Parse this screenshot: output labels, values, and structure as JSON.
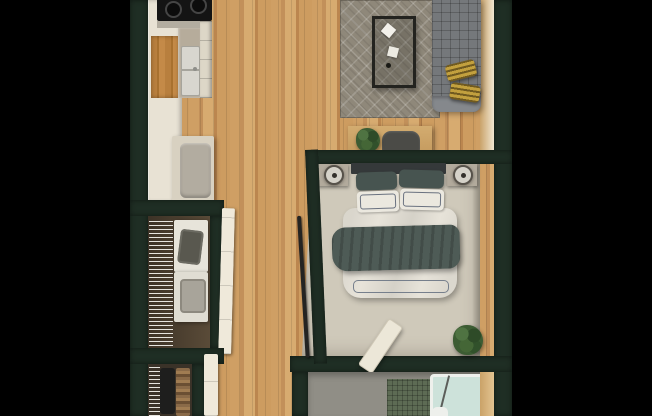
{
  "scene": {
    "type": "3d-top-down-apartment-floor-plan-render",
    "background": "#000000",
    "rooms": [
      {
        "name": "kitchen",
        "features": [
          "stove-cooktop",
          "double-sink",
          "counter",
          "cream-cabinets",
          "wood-accent-cabinet",
          "refrigerator",
          "drawer-stack"
        ]
      },
      {
        "name": "living-area",
        "features": [
          "area-rug-diamond-pattern",
          "coffee-table",
          "white-trays",
          "gray-tufted-sofa",
          "gold-throw-pillows",
          "console-table",
          "console-seat",
          "potted-plant"
        ]
      },
      {
        "name": "bedroom",
        "features": [
          "double-bed",
          "headboard",
          "dark-green-pillows",
          "white-pillows",
          "white-duvet",
          "dark-green-throw-blanket",
          "nightstand-left",
          "nightstand-right",
          "round-table-lamps",
          "leaning-board",
          "potted-plant",
          "angled-sliding-door",
          "door-handle-bar",
          "beige-carpet"
        ]
      },
      {
        "name": "laundry-closet",
        "features": [
          "stacked-washer-dryer",
          "laundry-basket",
          "wire-shelving",
          "closet-door"
        ]
      },
      {
        "name": "wardrobe-closet",
        "features": [
          "hanging-clothes",
          "wire-shelving",
          "closet-door"
        ]
      },
      {
        "name": "bathroom",
        "features": [
          "gray-tile-floor",
          "green-tiled-shower",
          "glass-enclosed-bathtub",
          "wood-vanity-edge",
          "toilet-partial"
        ]
      },
      {
        "name": "hallway",
        "features": [
          "wood-plank-floor"
        ]
      }
    ]
  },
  "palette": {
    "bg": "#000000",
    "wall": "#1f2e24",
    "wood": "#c9995d",
    "carpet": "#cfc9ba",
    "rug": "#8f887a",
    "cabinet": "#e8e2d4",
    "wood-accent": "#b87f3e",
    "counter": "#b6ac9b",
    "stove": "#141414",
    "steel": "#b3ada0",
    "sink": "#d8d6cf",
    "fridge-front": "#b2aca0",
    "sofa": "#75787b",
    "pillow-gold": "#c2a03e",
    "headboard": "#35393a",
    "pillow-green": "#475450",
    "linen": "#ebe8df",
    "duvet": "#e7e3d9",
    "throw": "#4e5b56",
    "nightstand": "#b2aa9c",
    "lamp-base": "#d5d2c9",
    "appliance": "#e7e4da",
    "closet-dark": "#3a3228",
    "laundry-dark": "#4a3e30",
    "bath-floor": "#908e86",
    "tile": "#5d6b54",
    "tub-glass": "#cde2da",
    "door": "#efe9da",
    "plant": "#3c5c33"
  }
}
